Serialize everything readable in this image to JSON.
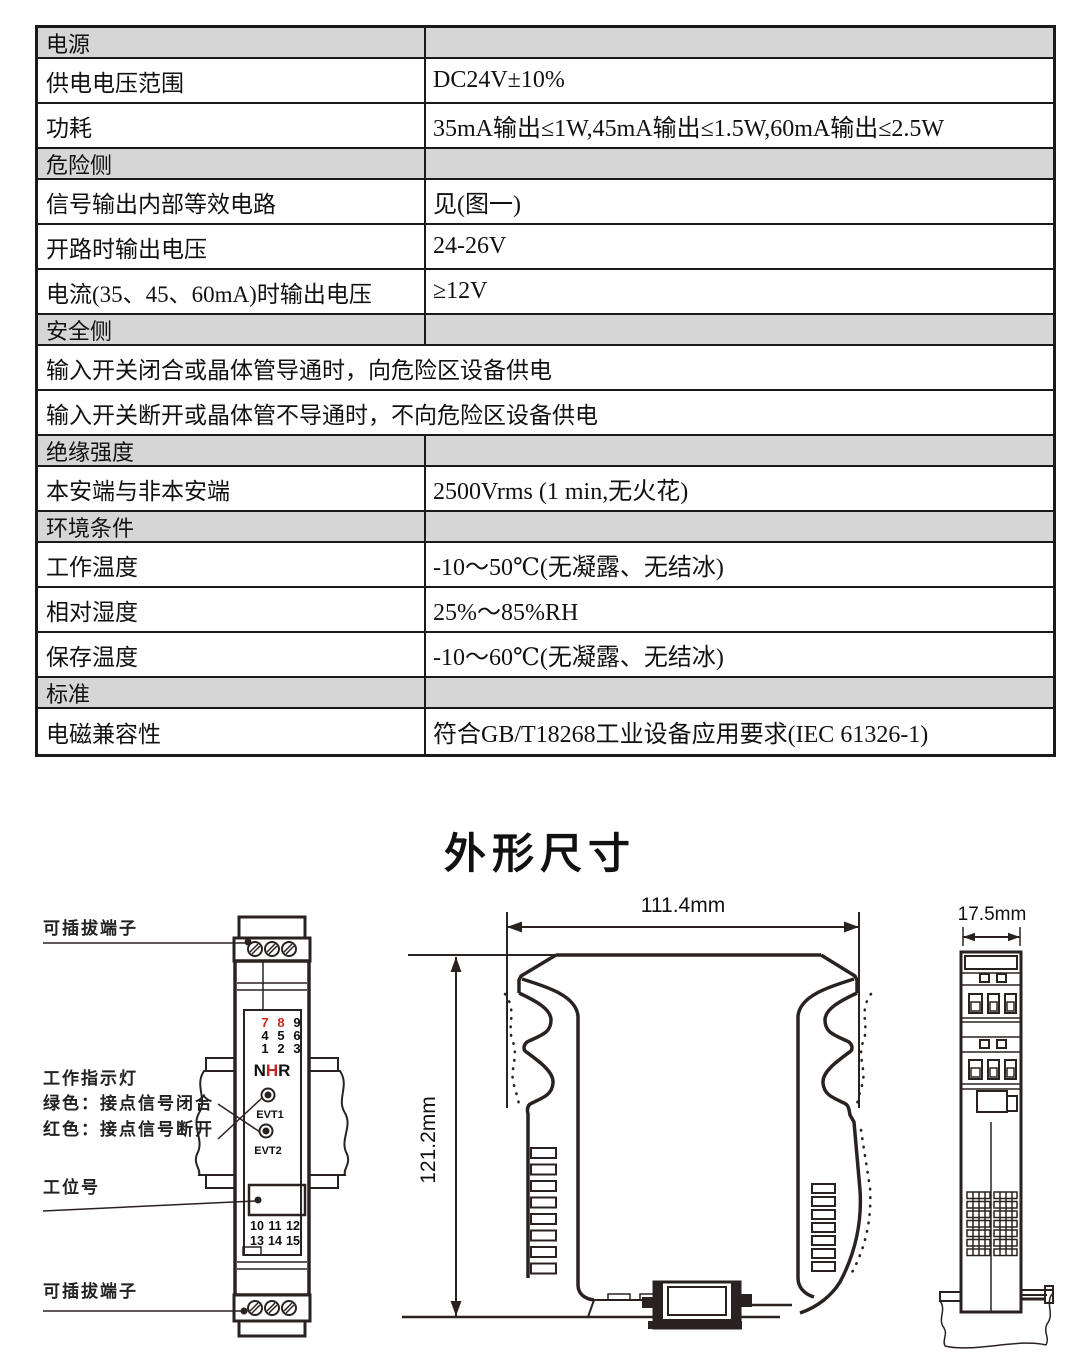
{
  "page": {
    "title": "外形尺寸"
  },
  "colors": {
    "accent_red": "#c8281e",
    "section_bg": "#d6d6d6",
    "line": "#2a2220"
  },
  "table": {
    "rows": [
      {
        "type": "section",
        "label": "电源"
      },
      {
        "type": "data",
        "label": "供电电压范围",
        "value": "DC24V±10%"
      },
      {
        "type": "data",
        "label": "功耗",
        "value": "35mA输出≤1W,45mA输出≤1.5W,60mA输出≤2.5W"
      },
      {
        "type": "section",
        "label": "危险侧"
      },
      {
        "type": "data",
        "label": "信号输出内部等效电路",
        "value": "见(图一)"
      },
      {
        "type": "data",
        "label": "开路时输出电压",
        "value": "24-26V"
      },
      {
        "type": "data",
        "label": "电流(35、45、60mA)时输出电压",
        "value": "≥12V"
      },
      {
        "type": "section",
        "label": "安全侧"
      },
      {
        "type": "full",
        "label": "输入开关闭合或晶体管导通时，向危险区设备供电"
      },
      {
        "type": "full",
        "label": "输入开关断开或晶体管不导通时，不向危险区设备供电"
      },
      {
        "type": "section",
        "label": "绝缘强度"
      },
      {
        "type": "data",
        "label": "本安端与非本安端",
        "value": "2500Vrms (1 min,无火花)"
      },
      {
        "type": "section",
        "label": "环境条件"
      },
      {
        "type": "data",
        "label": "工作温度",
        "value": "-10～50℃(无凝露、无结冰)"
      },
      {
        "type": "data",
        "label": "相对湿度",
        "value": "25%～85%RH"
      },
      {
        "type": "data",
        "label": "保存温度",
        "value": "-10～60℃(无凝露、无结冰)"
      },
      {
        "type": "section",
        "label": "标准"
      },
      {
        "type": "data",
        "label": "电磁兼容性",
        "value": "符合GB/T18268工业设备应用要求(IEC 61326-1)"
      }
    ]
  },
  "drawings": {
    "front_view": {
      "label_terminal_top": "可插拔端子",
      "label_indicator_title": "工作指示灯",
      "label_indicator_green": "绿色：接点信号闭合",
      "label_indicator_red": "红色：接点信号断开",
      "label_station": "工位号",
      "label_terminal_bottom": "可插拔端子",
      "digits_top": [
        "7",
        "8",
        "9",
        "4",
        "5",
        "6",
        "1",
        "2",
        "3"
      ],
      "digits_bottom": [
        "10",
        "11",
        "12",
        "13",
        "14",
        "15"
      ],
      "logo_letters": [
        "N",
        "H",
        "R"
      ],
      "led1_label": "EVT1",
      "led2_label": "EVT2"
    },
    "side_view": {
      "width_dim": "111.4mm",
      "height_dim": "121.2mm"
    },
    "end_view": {
      "depth_dim": "17.5mm"
    }
  }
}
